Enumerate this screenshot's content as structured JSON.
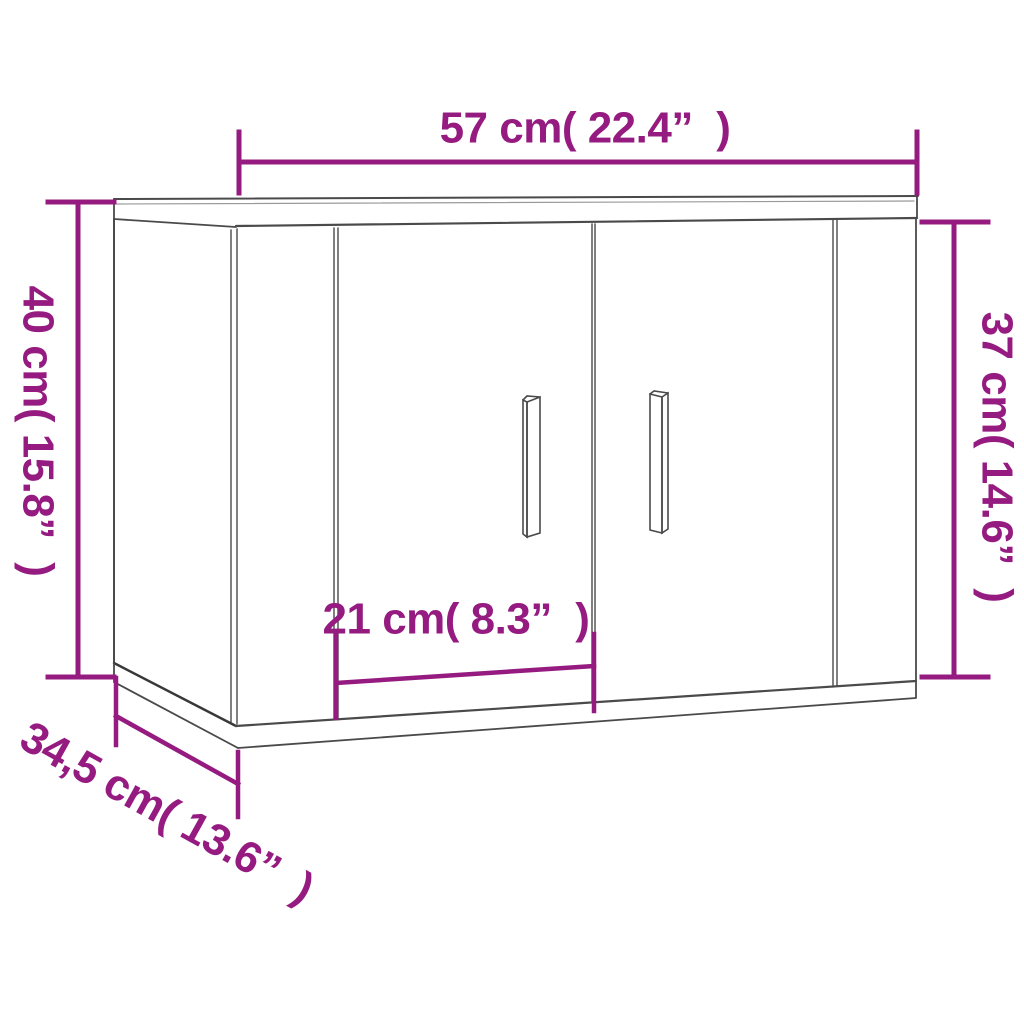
{
  "image_type": "furniture-dimension-diagram",
  "subject": "wall-mounted two-door cabinet line drawing",
  "colors": {
    "background": "#ffffff",
    "dimension": "#951b81",
    "cabinet_line": "#4a4a4a",
    "cabinet_line_dark": "#383838",
    "cabinet_line_light": "#9a9a9a"
  },
  "dimensions": {
    "top_width": {
      "cm": "57",
      "inches": "22.4",
      "label": "57 cm( 22.4”  )"
    },
    "left_height": {
      "cm": "40",
      "inches": "15.8",
      "label": "40 cm( 15.8”  )"
    },
    "right_height": {
      "cm": "37",
      "inches": "14.6",
      "label": "37 cm( 14.6”  )"
    },
    "door_width": {
      "cm": "21",
      "inches": "8.3",
      "label": "21 cm( 8.3”  )"
    },
    "depth": {
      "cm": "34,5",
      "inches": "13.6",
      "label": "34,5 cm( 13.6”  )"
    }
  }
}
